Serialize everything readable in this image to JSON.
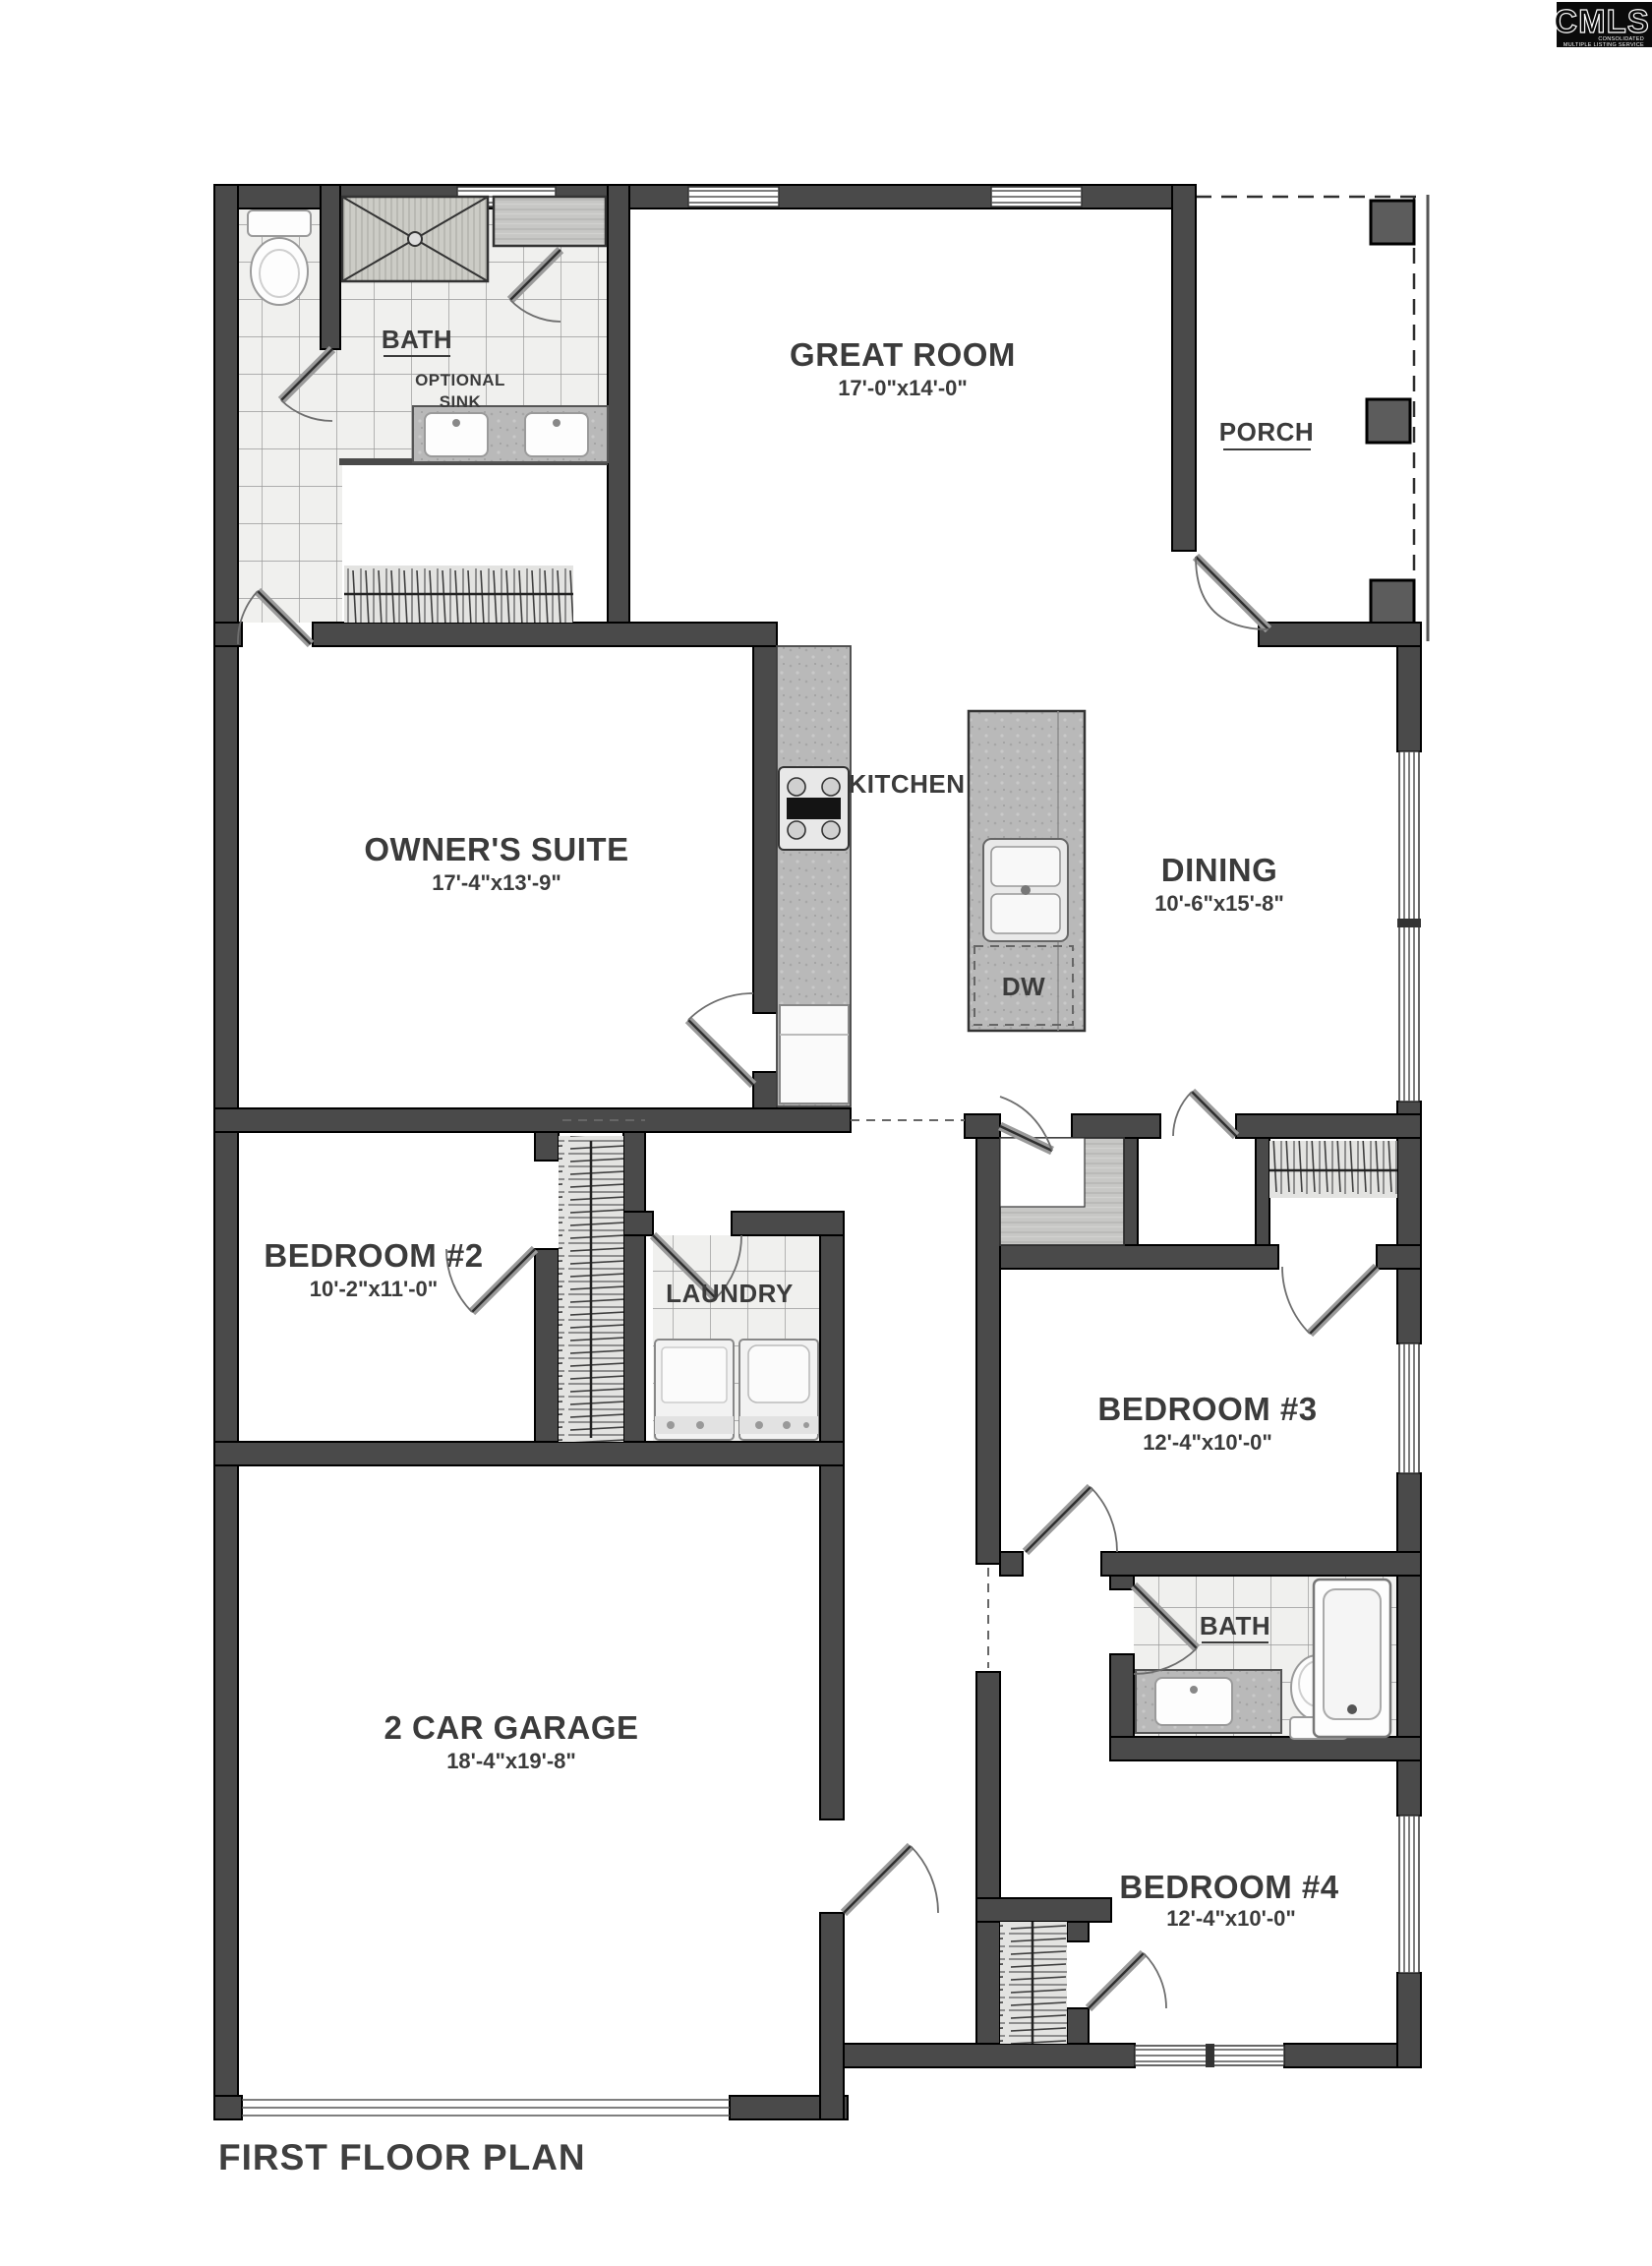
{
  "page": {
    "title": "FIRST FLOOR PLAN"
  },
  "logo": {
    "name": "CMLS",
    "tag1": "CONSOLIDATED",
    "tag2": "MULTIPLE LISTING SERVICE"
  },
  "colors": {
    "wall": "#4a4a4a",
    "text": "#3b3b3b",
    "floor": "#ffffff"
  },
  "rooms": {
    "bath1": {
      "label": "BATH",
      "note1": "OPTIONAL",
      "note2": "SINK"
    },
    "great": {
      "label": "GREAT ROOM",
      "dims": "17'-0\"x14'-0\""
    },
    "porch": {
      "label": "PORCH"
    },
    "owners": {
      "label": "OWNER'S SUITE",
      "dims": "17'-4\"x13'-9\""
    },
    "kitchen": {
      "label": "KITCHEN"
    },
    "dining": {
      "label": "DINING",
      "dims": "10'-6\"x15'-8\""
    },
    "island": {
      "dw": "DW"
    },
    "bed2": {
      "label": "BEDROOM #2",
      "dims": "10'-2\"x11'-0\""
    },
    "laundry": {
      "label": "LAUNDRY"
    },
    "bed3": {
      "label": "BEDROOM #3",
      "dims": "12'-4\"x10'-0\""
    },
    "bath2": {
      "label": "BATH"
    },
    "garage": {
      "label": "2 CAR GARAGE",
      "dims": "18'-4\"x19'-8\""
    },
    "bed4": {
      "label": "BEDROOM #4",
      "dims": "12'-4\"x10'-0\""
    }
  }
}
